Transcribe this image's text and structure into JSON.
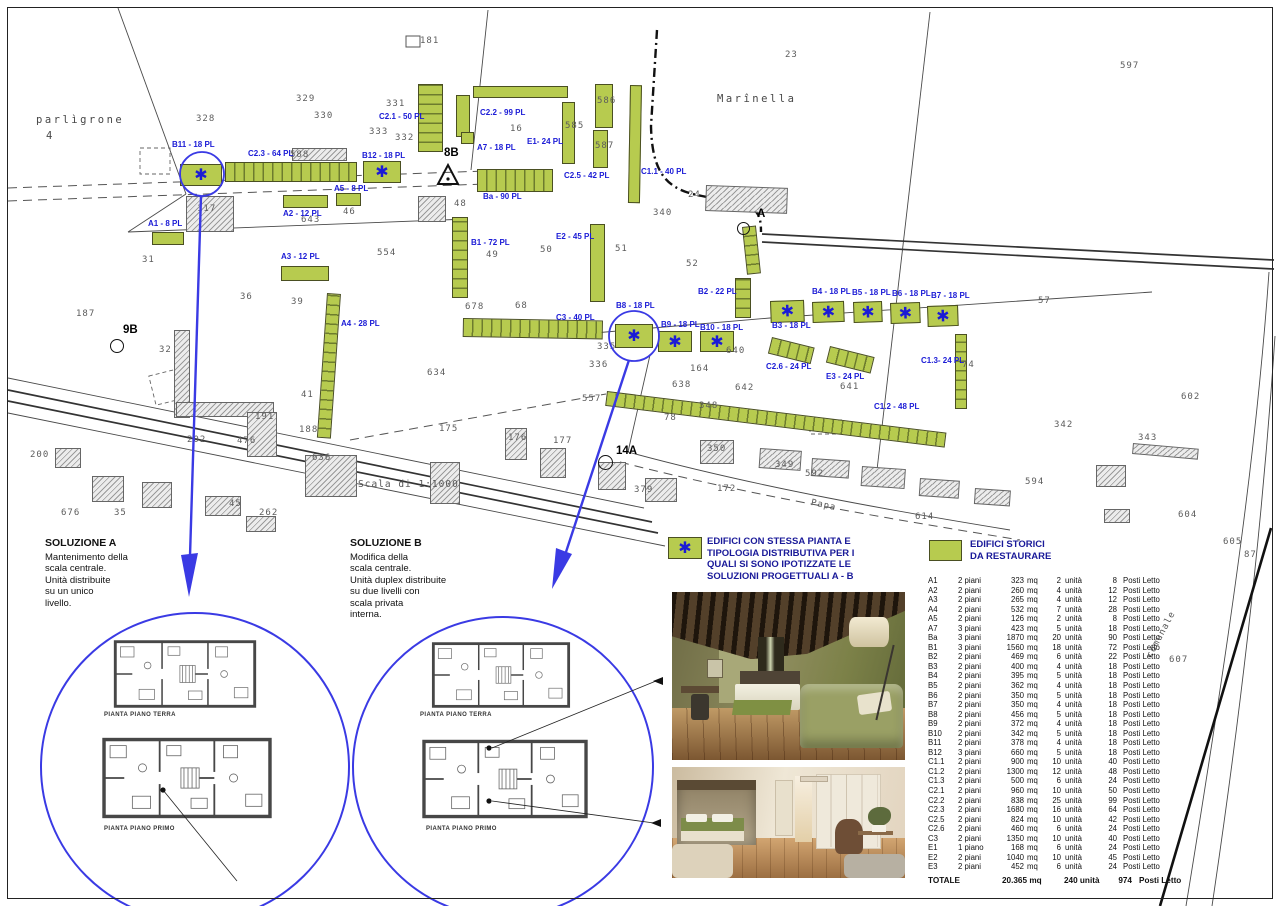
{
  "map": {
    "scale_note": "Scala di 1:1000",
    "asterisk_glyph": "✱",
    "green_buildings": [
      {
        "id": "B11",
        "x": 180,
        "y": 164,
        "w": 42,
        "h": 22,
        "a": true
      },
      {
        "id": "C2.3",
        "x": 225,
        "y": 162,
        "w": 132,
        "h": 20,
        "ht": "v"
      },
      {
        "id": "B12",
        "x": 363,
        "y": 161,
        "w": 38,
        "h": 22,
        "a": true
      },
      {
        "id": "A1",
        "x": 152,
        "y": 232,
        "w": 32,
        "h": 13
      },
      {
        "id": "A2",
        "x": 283,
        "y": 195,
        "w": 45,
        "h": 13
      },
      {
        "id": "A3",
        "x": 281,
        "y": 266,
        "w": 48,
        "h": 15
      },
      {
        "id": "A5",
        "x": 336,
        "y": 193,
        "w": 25,
        "h": 13
      },
      {
        "id": "A4",
        "x": 327,
        "y": 293,
        "w": 14,
        "h": 145,
        "r": 4,
        "ht": "h"
      },
      {
        "id": "C2.1",
        "x": 418,
        "y": 84,
        "w": 25,
        "h": 68,
        "ht": "h"
      },
      {
        "id": "C2.2",
        "x": 473,
        "y": 86,
        "w": 95,
        "h": 12
      },
      {
        "id": "C2.2",
        "x": 456,
        "y": 95,
        "w": 14,
        "h": 42
      },
      {
        "id": "C2.2",
        "x": 461,
        "y": 132,
        "w": 13,
        "h": 12
      },
      {
        "id": "E1",
        "x": 562,
        "y": 102,
        "w": 13,
        "h": 62
      },
      {
        "id": "Ba",
        "x": 477,
        "y": 169,
        "w": 76,
        "h": 23,
        "ht": "v"
      },
      {
        "id": "C2.5",
        "x": 595,
        "y": 84,
        "w": 18,
        "h": 44
      },
      {
        "id": "C2.5",
        "x": 593,
        "y": 130,
        "w": 15,
        "h": 38
      },
      {
        "id": "C1.1",
        "x": 630,
        "y": 85,
        "w": 12,
        "h": 118,
        "r": 1
      },
      {
        "id": "B1",
        "x": 452,
        "y": 217,
        "w": 16,
        "h": 81,
        "ht": "h"
      },
      {
        "id": "E2",
        "x": 590,
        "y": 224,
        "w": 15,
        "h": 78
      },
      {
        "id": "C3",
        "x": 463,
        "y": 318,
        "w": 140,
        "h": 19,
        "r": 1,
        "ht": "v"
      },
      {
        "id": "54",
        "x": 742,
        "y": 227,
        "w": 14,
        "h": 48,
        "r": -6,
        "ht": "h"
      },
      {
        "id": "B2",
        "x": 735,
        "y": 278,
        "w": 16,
        "h": 40,
        "ht": "h"
      },
      {
        "id": "B8",
        "x": 615,
        "y": 324,
        "w": 38,
        "h": 24,
        "a": true
      },
      {
        "id": "B9",
        "x": 658,
        "y": 331,
        "w": 34,
        "h": 21,
        "a": true
      },
      {
        "id": "B10",
        "x": 700,
        "y": 331,
        "w": 34,
        "h": 21,
        "a": true
      },
      {
        "id": "B3",
        "x": 770,
        "y": 301,
        "w": 34,
        "h": 22,
        "r": -2,
        "a": true
      },
      {
        "id": "B4",
        "x": 812,
        "y": 302,
        "w": 32,
        "h": 21,
        "r": -2,
        "a": true
      },
      {
        "id": "B5",
        "x": 853,
        "y": 302,
        "w": 29,
        "h": 21,
        "r": -2,
        "a": true
      },
      {
        "id": "B6",
        "x": 890,
        "y": 303,
        "w": 30,
        "h": 21,
        "r": -2,
        "a": true
      },
      {
        "id": "B7",
        "x": 927,
        "y": 306,
        "w": 31,
        "h": 21,
        "r": -2,
        "a": true
      },
      {
        "id": "C2.6",
        "x": 772,
        "y": 337,
        "w": 44,
        "h": 17,
        "r": 14,
        "ht": "v"
      },
      {
        "id": "E3",
        "x": 830,
        "y": 346,
        "w": 46,
        "h": 17,
        "r": 14,
        "ht": "v"
      },
      {
        "id": "C1.3",
        "x": 955,
        "y": 334,
        "w": 12,
        "h": 75,
        "ht": "h"
      },
      {
        "id": "C1.2",
        "x": 607,
        "y": 391,
        "w": 342,
        "h": 15,
        "r": 7,
        "ht": "v"
      }
    ],
    "gray_buildings": [
      {
        "x": 186,
        "y": 196,
        "w": 48,
        "h": 36
      },
      {
        "x": 174,
        "y": 330,
        "w": 16,
        "h": 88
      },
      {
        "x": 176,
        "y": 402,
        "w": 98,
        "h": 15
      },
      {
        "x": 247,
        "y": 412,
        "w": 30,
        "h": 45
      },
      {
        "x": 292,
        "y": 148,
        "w": 55,
        "h": 13
      },
      {
        "x": 418,
        "y": 196,
        "w": 28,
        "h": 26
      },
      {
        "x": 706,
        "y": 185,
        "w": 82,
        "h": 26,
        "r": 2
      },
      {
        "x": 55,
        "y": 448,
        "w": 26,
        "h": 20
      },
      {
        "x": 92,
        "y": 476,
        "w": 32,
        "h": 26
      },
      {
        "x": 142,
        "y": 482,
        "w": 30,
        "h": 26
      },
      {
        "x": 205,
        "y": 496,
        "w": 36,
        "h": 20
      },
      {
        "x": 246,
        "y": 516,
        "w": 30,
        "h": 16
      },
      {
        "x": 305,
        "y": 455,
        "w": 52,
        "h": 42
      },
      {
        "x": 430,
        "y": 462,
        "w": 30,
        "h": 42
      },
      {
        "x": 505,
        "y": 428,
        "w": 22,
        "h": 32
      },
      {
        "x": 540,
        "y": 448,
        "w": 26,
        "h": 30
      },
      {
        "x": 598,
        "y": 462,
        "w": 28,
        "h": 28
      },
      {
        "x": 645,
        "y": 478,
        "w": 32,
        "h": 24
      },
      {
        "x": 700,
        "y": 440,
        "w": 34,
        "h": 24
      },
      {
        "x": 760,
        "y": 448,
        "w": 42,
        "h": 20,
        "r": 4
      },
      {
        "x": 812,
        "y": 458,
        "w": 38,
        "h": 18,
        "r": 4
      },
      {
        "x": 862,
        "y": 466,
        "w": 44,
        "h": 20,
        "r": 4
      },
      {
        "x": 920,
        "y": 478,
        "w": 40,
        "h": 18,
        "r": 4
      },
      {
        "x": 975,
        "y": 488,
        "w": 36,
        "h": 16,
        "r": 4
      },
      {
        "x": 1133,
        "y": 443,
        "w": 66,
        "h": 11,
        "r": 5
      },
      {
        "x": 1096,
        "y": 465,
        "w": 30,
        "h": 22
      },
      {
        "x": 1104,
        "y": 509,
        "w": 26,
        "h": 14
      }
    ],
    "building_labels": [
      {
        "t": "A1 - 8 PL",
        "x": 148,
        "y": 219
      },
      {
        "t": "B11 - 18 PL",
        "x": 172,
        "y": 140
      },
      {
        "t": "C2.3 - 64 PL",
        "x": 248,
        "y": 149
      },
      {
        "t": "B12 - 18 PL",
        "x": 362,
        "y": 151
      },
      {
        "t": "A5 - 8 PL",
        "x": 334,
        "y": 184
      },
      {
        "t": "A2 - 12 PL",
        "x": 283,
        "y": 209
      },
      {
        "t": "A3 - 12 PL",
        "x": 281,
        "y": 252
      },
      {
        "t": "A4 - 28 PL",
        "x": 341,
        "y": 319
      },
      {
        "t": "C2.1 - 50 PL",
        "x": 379,
        "y": 112
      },
      {
        "t": "C2.2 - 99 PL",
        "x": 480,
        "y": 108
      },
      {
        "t": "A7 - 18 PL",
        "x": 477,
        "y": 143
      },
      {
        "t": "E1- 24 PL",
        "x": 527,
        "y": 137
      },
      {
        "t": "C2.5 - 42 PL",
        "x": 564,
        "y": 171
      },
      {
        "t": "C1.1 - 40 PL",
        "x": 641,
        "y": 167
      },
      {
        "t": "Ba - 90 PL",
        "x": 483,
        "y": 192
      },
      {
        "t": "B1 - 72 PL",
        "x": 471,
        "y": 238
      },
      {
        "t": "E2 - 45 PL",
        "x": 556,
        "y": 232
      },
      {
        "t": "C3 - 40 PL",
        "x": 556,
        "y": 313
      },
      {
        "t": "B8 - 18 PL",
        "x": 616,
        "y": 301
      },
      {
        "t": "B2 - 22 PL",
        "x": 698,
        "y": 287
      },
      {
        "t": "B9 - 18 PL",
        "x": 661,
        "y": 320
      },
      {
        "t": "B10 - 18 PL",
        "x": 700,
        "y": 323
      },
      {
        "t": "B3 - 18 PL",
        "x": 772,
        "y": 321
      },
      {
        "t": "B4 - 18 PL",
        "x": 812,
        "y": 287
      },
      {
        "t": "B5 - 18 PL",
        "x": 852,
        "y": 288
      },
      {
        "t": "B6 - 18 PL",
        "x": 892,
        "y": 289
      },
      {
        "t": "B7 - 18 PL",
        "x": 931,
        "y": 291
      },
      {
        "t": "C2.6 - 24 PL",
        "x": 766,
        "y": 362
      },
      {
        "t": "E3 - 24 PL",
        "x": 826,
        "y": 372
      },
      {
        "t": "C1.3- 24 PL",
        "x": 921,
        "y": 356
      },
      {
        "t": "C1.2 - 48 PL",
        "x": 874,
        "y": 402
      }
    ],
    "parcel_texts": [
      {
        "t": "parlìgrone",
        "x": 36,
        "y": 114,
        "cls": "area"
      },
      {
        "t": "4",
        "x": 46,
        "y": 130,
        "cls": "area"
      },
      {
        "t": "Marînella",
        "x": 717,
        "y": 93,
        "cls": "area"
      },
      {
        "t": "Scala di 1:1000",
        "x": 358,
        "y": 479,
        "cls": "scale"
      },
      {
        "t": "comunale",
        "x": 1145,
        "y": 655,
        "cls": "road",
        "rot": -62
      },
      {
        "t": "Papa",
        "x": 812,
        "y": 498,
        "cls": "road",
        "rot": 12
      },
      {
        "t": "23",
        "x": 785,
        "y": 50
      },
      {
        "t": "597",
        "x": 1120,
        "y": 61
      },
      {
        "t": "181",
        "x": 420,
        "y": 36
      },
      {
        "t": "329",
        "x": 296,
        "y": 94
      },
      {
        "t": "328",
        "x": 196,
        "y": 114
      },
      {
        "t": "330",
        "x": 314,
        "y": 111
      },
      {
        "t": "331",
        "x": 386,
        "y": 99
      },
      {
        "t": "333",
        "x": 369,
        "y": 127
      },
      {
        "t": "332",
        "x": 395,
        "y": 133
      },
      {
        "t": "16",
        "x": 510,
        "y": 124
      },
      {
        "t": "585",
        "x": 565,
        "y": 121
      },
      {
        "t": "586",
        "x": 597,
        "y": 96
      },
      {
        "t": "587",
        "x": 595,
        "y": 141
      },
      {
        "t": "588",
        "x": 290,
        "y": 150
      },
      {
        "t": "340",
        "x": 653,
        "y": 208
      },
      {
        "t": "24",
        "x": 688,
        "y": 190
      },
      {
        "t": "117",
        "x": 197,
        "y": 204
      },
      {
        "t": "643",
        "x": 301,
        "y": 215
      },
      {
        "t": "46",
        "x": 343,
        "y": 207
      },
      {
        "t": "554",
        "x": 377,
        "y": 248
      },
      {
        "t": "48",
        "x": 454,
        "y": 199
      },
      {
        "t": "49",
        "x": 486,
        "y": 250
      },
      {
        "t": "50",
        "x": 540,
        "y": 245
      },
      {
        "t": "51",
        "x": 615,
        "y": 244
      },
      {
        "t": "52",
        "x": 686,
        "y": 259
      },
      {
        "t": "57",
        "x": 1038,
        "y": 296
      },
      {
        "t": "31",
        "x": 142,
        "y": 255
      },
      {
        "t": "36",
        "x": 240,
        "y": 292
      },
      {
        "t": "39",
        "x": 291,
        "y": 297
      },
      {
        "t": "187",
        "x": 76,
        "y": 309
      },
      {
        "t": "32",
        "x": 159,
        "y": 345
      },
      {
        "t": "41",
        "x": 301,
        "y": 390
      },
      {
        "t": "191",
        "x": 255,
        "y": 412
      },
      {
        "t": "188",
        "x": 299,
        "y": 425
      },
      {
        "t": "202",
        "x": 187,
        "y": 435
      },
      {
        "t": "476",
        "x": 237,
        "y": 436
      },
      {
        "t": "636",
        "x": 312,
        "y": 453
      },
      {
        "t": "200",
        "x": 30,
        "y": 450
      },
      {
        "t": "676",
        "x": 61,
        "y": 508
      },
      {
        "t": "35",
        "x": 114,
        "y": 508
      },
      {
        "t": "45",
        "x": 229,
        "y": 499
      },
      {
        "t": "262",
        "x": 259,
        "y": 508
      },
      {
        "t": "634",
        "x": 427,
        "y": 368
      },
      {
        "t": "678",
        "x": 465,
        "y": 302
      },
      {
        "t": "68",
        "x": 515,
        "y": 301
      },
      {
        "t": "335",
        "x": 597,
        "y": 342
      },
      {
        "t": "336",
        "x": 589,
        "y": 360
      },
      {
        "t": "164",
        "x": 690,
        "y": 364
      },
      {
        "t": "638",
        "x": 672,
        "y": 380
      },
      {
        "t": "640",
        "x": 726,
        "y": 346
      },
      {
        "t": "642",
        "x": 735,
        "y": 383
      },
      {
        "t": "348",
        "x": 699,
        "y": 401
      },
      {
        "t": "78",
        "x": 664,
        "y": 413
      },
      {
        "t": "641",
        "x": 840,
        "y": 382
      },
      {
        "t": "74",
        "x": 962,
        "y": 360
      },
      {
        "t": "602",
        "x": 1181,
        "y": 392
      },
      {
        "t": "343",
        "x": 1138,
        "y": 433
      },
      {
        "t": "342",
        "x": 1054,
        "y": 420
      },
      {
        "t": "594",
        "x": 1025,
        "y": 477
      },
      {
        "t": "604",
        "x": 1178,
        "y": 510
      },
      {
        "t": "605",
        "x": 1223,
        "y": 537
      },
      {
        "t": "87",
        "x": 1244,
        "y": 550
      },
      {
        "t": "607",
        "x": 1169,
        "y": 655
      },
      {
        "t": "557",
        "x": 582,
        "y": 394
      },
      {
        "t": "175",
        "x": 439,
        "y": 424
      },
      {
        "t": "176",
        "x": 508,
        "y": 433
      },
      {
        "t": "177",
        "x": 553,
        "y": 436
      },
      {
        "t": "172",
        "x": 717,
        "y": 484
      },
      {
        "t": "350",
        "x": 707,
        "y": 444
      },
      {
        "t": "592",
        "x": 805,
        "y": 469
      },
      {
        "t": "349",
        "x": 775,
        "y": 460
      },
      {
        "t": "614",
        "x": 915,
        "y": 512
      },
      {
        "t": "379",
        "x": 634,
        "y": 485
      }
    ],
    "markers": [
      {
        "t": "8B",
        "x": 444,
        "y": 147
      },
      {
        "t": "9B",
        "x": 123,
        "y": 324,
        "c": [
          110,
          339,
          14
        ]
      },
      {
        "t": "A",
        "x": 757,
        "y": 208,
        "c": [
          737,
          222,
          13
        ]
      },
      {
        "t": "14A",
        "x": 616,
        "y": 445,
        "c": [
          598,
          455,
          15
        ]
      }
    ]
  },
  "solution_a": {
    "title": "SOLUZIONE  A",
    "lines": [
      "Mantenimento della",
      "scala centrale.",
      "Unità distribuite",
      "su un unico",
      "livello."
    ]
  },
  "solution_b": {
    "title": "SOLUZIONE  B",
    "lines": [
      "Modifica della",
      "scala centrale.",
      "Unità duplex distribuite",
      "su due livelli con",
      "scala privata",
      "interna."
    ]
  },
  "plans": {
    "terra_label": "PIANTA PIANO TERRA",
    "primo_label": "PIANTA PIANO PRIMO"
  },
  "legend": {
    "items": [
      {
        "symbol": "asterisk-box",
        "lines": [
          "EDIFICI CON STESSA PIANTA E",
          "TIPOLOGIA DISTRIBUTIVA PER I",
          "QUALI SI SONO IPOTIZZATE LE",
          "SOLUZIONI PROGETTUALI  A - B"
        ]
      },
      {
        "symbol": "green-box",
        "lines": [
          "EDIFICI STORICI",
          "DA RESTAURARE"
        ]
      }
    ]
  },
  "table": {
    "units": {
      "mq": "mq",
      "unita": "unità",
      "posti": "Posti Letto"
    },
    "rows": [
      [
        "A1",
        "2 piani",
        "323",
        "2",
        "8"
      ],
      [
        "A2",
        "2 piani",
        "260",
        "4",
        "12"
      ],
      [
        "A3",
        "2 piani",
        "265",
        "4",
        "12"
      ],
      [
        "A4",
        "2 piani",
        "532",
        "7",
        "28"
      ],
      [
        "A5",
        "2 piani",
        "126",
        "2",
        "8"
      ],
      [
        "A7",
        "3 piani",
        "423",
        "5",
        "18"
      ],
      [
        "Ba",
        "3 piani",
        "1870",
        "20",
        "90"
      ],
      [
        "B1",
        "3 piani",
        "1560",
        "18",
        "72"
      ],
      [
        "B2",
        "2 piani",
        "469",
        "6",
        "22"
      ],
      [
        "B3",
        "2 piani",
        "400",
        "4",
        "18"
      ],
      [
        "B4",
        "2 piani",
        "395",
        "5",
        "18"
      ],
      [
        "B5",
        "2 piani",
        "362",
        "4",
        "18"
      ],
      [
        "B6",
        "2 piani",
        "350",
        "5",
        "18"
      ],
      [
        "B7",
        "2 piani",
        "350",
        "4",
        "18"
      ],
      [
        "B8",
        "2 piani",
        "456",
        "5",
        "18"
      ],
      [
        "B9",
        "2 piani",
        "372",
        "4",
        "18"
      ],
      [
        "B10",
        "2 piani",
        "342",
        "5",
        "18"
      ],
      [
        "B11",
        "2 piani",
        "378",
        "4",
        "18"
      ],
      [
        "B12",
        "3 piani",
        "660",
        "5",
        "18"
      ],
      [
        "C1.1",
        "2 piani",
        "900",
        "10",
        "40"
      ],
      [
        "C1.2",
        "2 piani",
        "1300",
        "12",
        "48"
      ],
      [
        "C1.3",
        "2 piani",
        "500",
        "6",
        "24"
      ],
      [
        "C2.1",
        "2 piani",
        "960",
        "10",
        "50"
      ],
      [
        "C2.2",
        "2 piani",
        "838",
        "25",
        "99"
      ],
      [
        "C2.3",
        "2 piani",
        "1680",
        "16",
        "64"
      ],
      [
        "C2.5",
        "2 piani",
        "824",
        "10",
        "42"
      ],
      [
        "C2.6",
        "2 piani",
        "460",
        "6",
        "24"
      ],
      [
        "C3",
        "2 piani",
        "1350",
        "10",
        "40"
      ],
      [
        "E1",
        "1 piano",
        "168",
        "6",
        "24"
      ],
      [
        "E2",
        "2 piani",
        "1040",
        "10",
        "45"
      ],
      [
        "E3",
        "2 piani",
        "452",
        "6",
        "24"
      ]
    ],
    "total": {
      "label": "TOTALE",
      "mq": "20.365 mq",
      "unita": "240 unità",
      "posti": "974",
      "posti_label": "Posti Letto"
    }
  },
  "colors": {
    "green": "#b7cb4f",
    "blue": "#1b1bd6",
    "legend_blue": "#1a1a99"
  }
}
